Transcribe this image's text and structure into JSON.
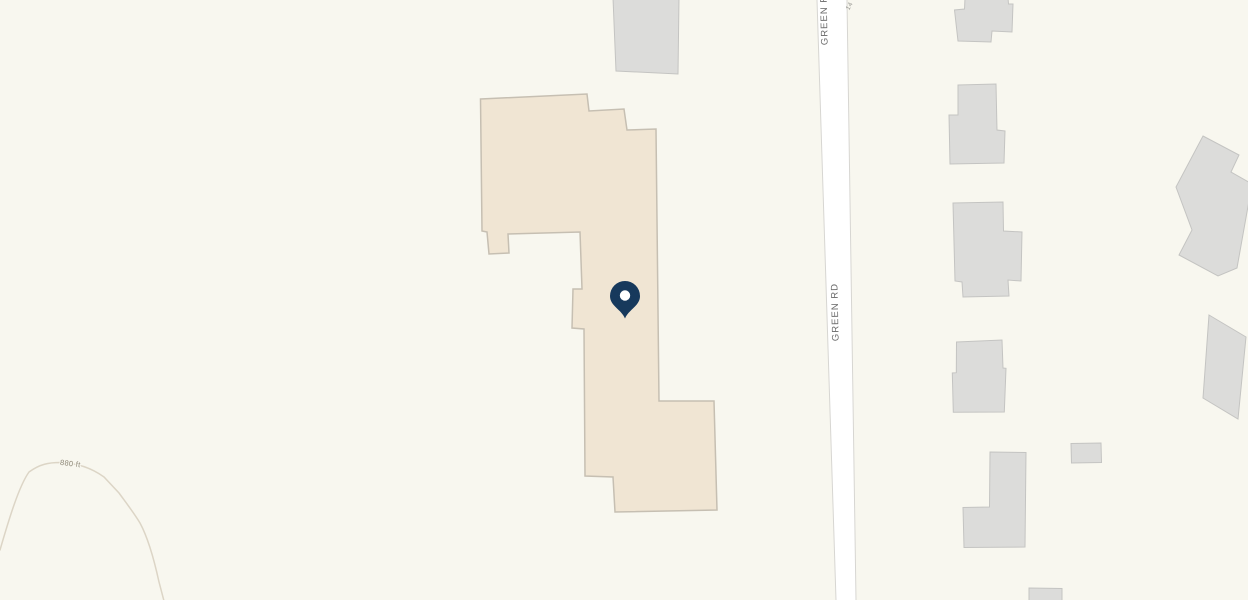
{
  "map": {
    "type": "parcel-map-view",
    "background_color": "#f8f7ef",
    "road": {
      "name": "GREEN RD",
      "label_mid": "GREEN RD",
      "label_top": "GREEN RD",
      "partial_top_label": "14",
      "fill": "#ffffff",
      "casing_color": "#d7d6d2",
      "label_color": "#6b6b6b",
      "partial_label_color": "#979792"
    },
    "contour": {
      "label": "880 ft",
      "elevation_ft": 880,
      "line_color": "#dcd5c6",
      "label_color": "#8d8776"
    },
    "marker": {
      "icon": "location-pin-icon",
      "fill": "#17395c",
      "hole_color": "#ffffff"
    },
    "highlighted_building": {
      "fill": "#f0e5d3",
      "outline": "#c6bfb2"
    },
    "neighbor_buildings": {
      "fill": "#dcdcda",
      "outline": "#c4c4c2",
      "count": 10
    }
  }
}
